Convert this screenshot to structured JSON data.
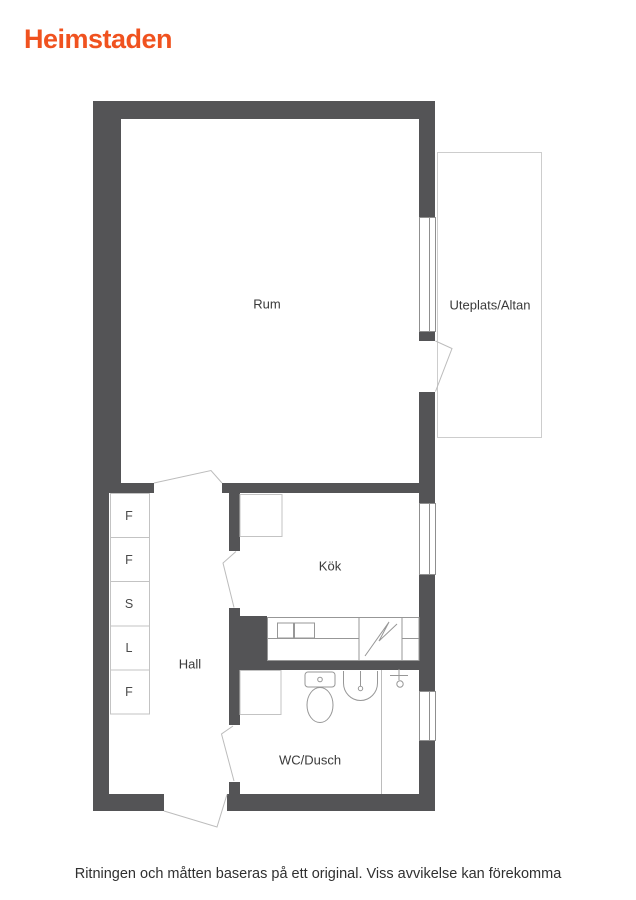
{
  "logo": {
    "text": "Heimstaden",
    "color": "#f0521f"
  },
  "floorplan": {
    "rooms": {
      "rum": "Rum",
      "uteplats": "Uteplats/Altan",
      "kok": "Kök",
      "hall": "Hall",
      "wc": "WC/Dusch"
    },
    "closets": [
      "F",
      "F",
      "S",
      "L",
      "F"
    ],
    "colors": {
      "wall": "#545456",
      "thin_line": "#c3c3c3",
      "fixture_line": "#979797",
      "window_line": "#8f8f8f"
    }
  },
  "footer": {
    "disclaimer": "Ritningen och måtten baseras på ett original. Viss avvikelse kan förekomma"
  }
}
